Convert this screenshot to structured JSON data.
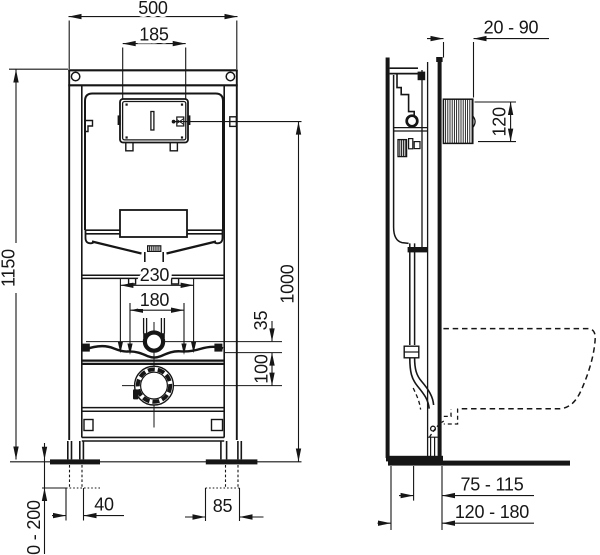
{
  "front": {
    "overall_width": "500",
    "plate_cutout_width": "185",
    "frame_height": "1150",
    "plate_center_height": "1000",
    "upper_fixing_span": "230",
    "pipe_fixing_span": "180",
    "pipe_offset": "35",
    "outlet_spacing": "100",
    "left_foot_slot": "40",
    "right_foot_slot": "85",
    "floor_adjustment": "0 - 200"
  },
  "side": {
    "wall_gap": "20 - 90",
    "spigot_height": "120",
    "outlet_to_front": "75 - 115",
    "depth_range": "120 - 180"
  },
  "colors": {
    "ink": "#161616",
    "paper": "#ffffff"
  }
}
